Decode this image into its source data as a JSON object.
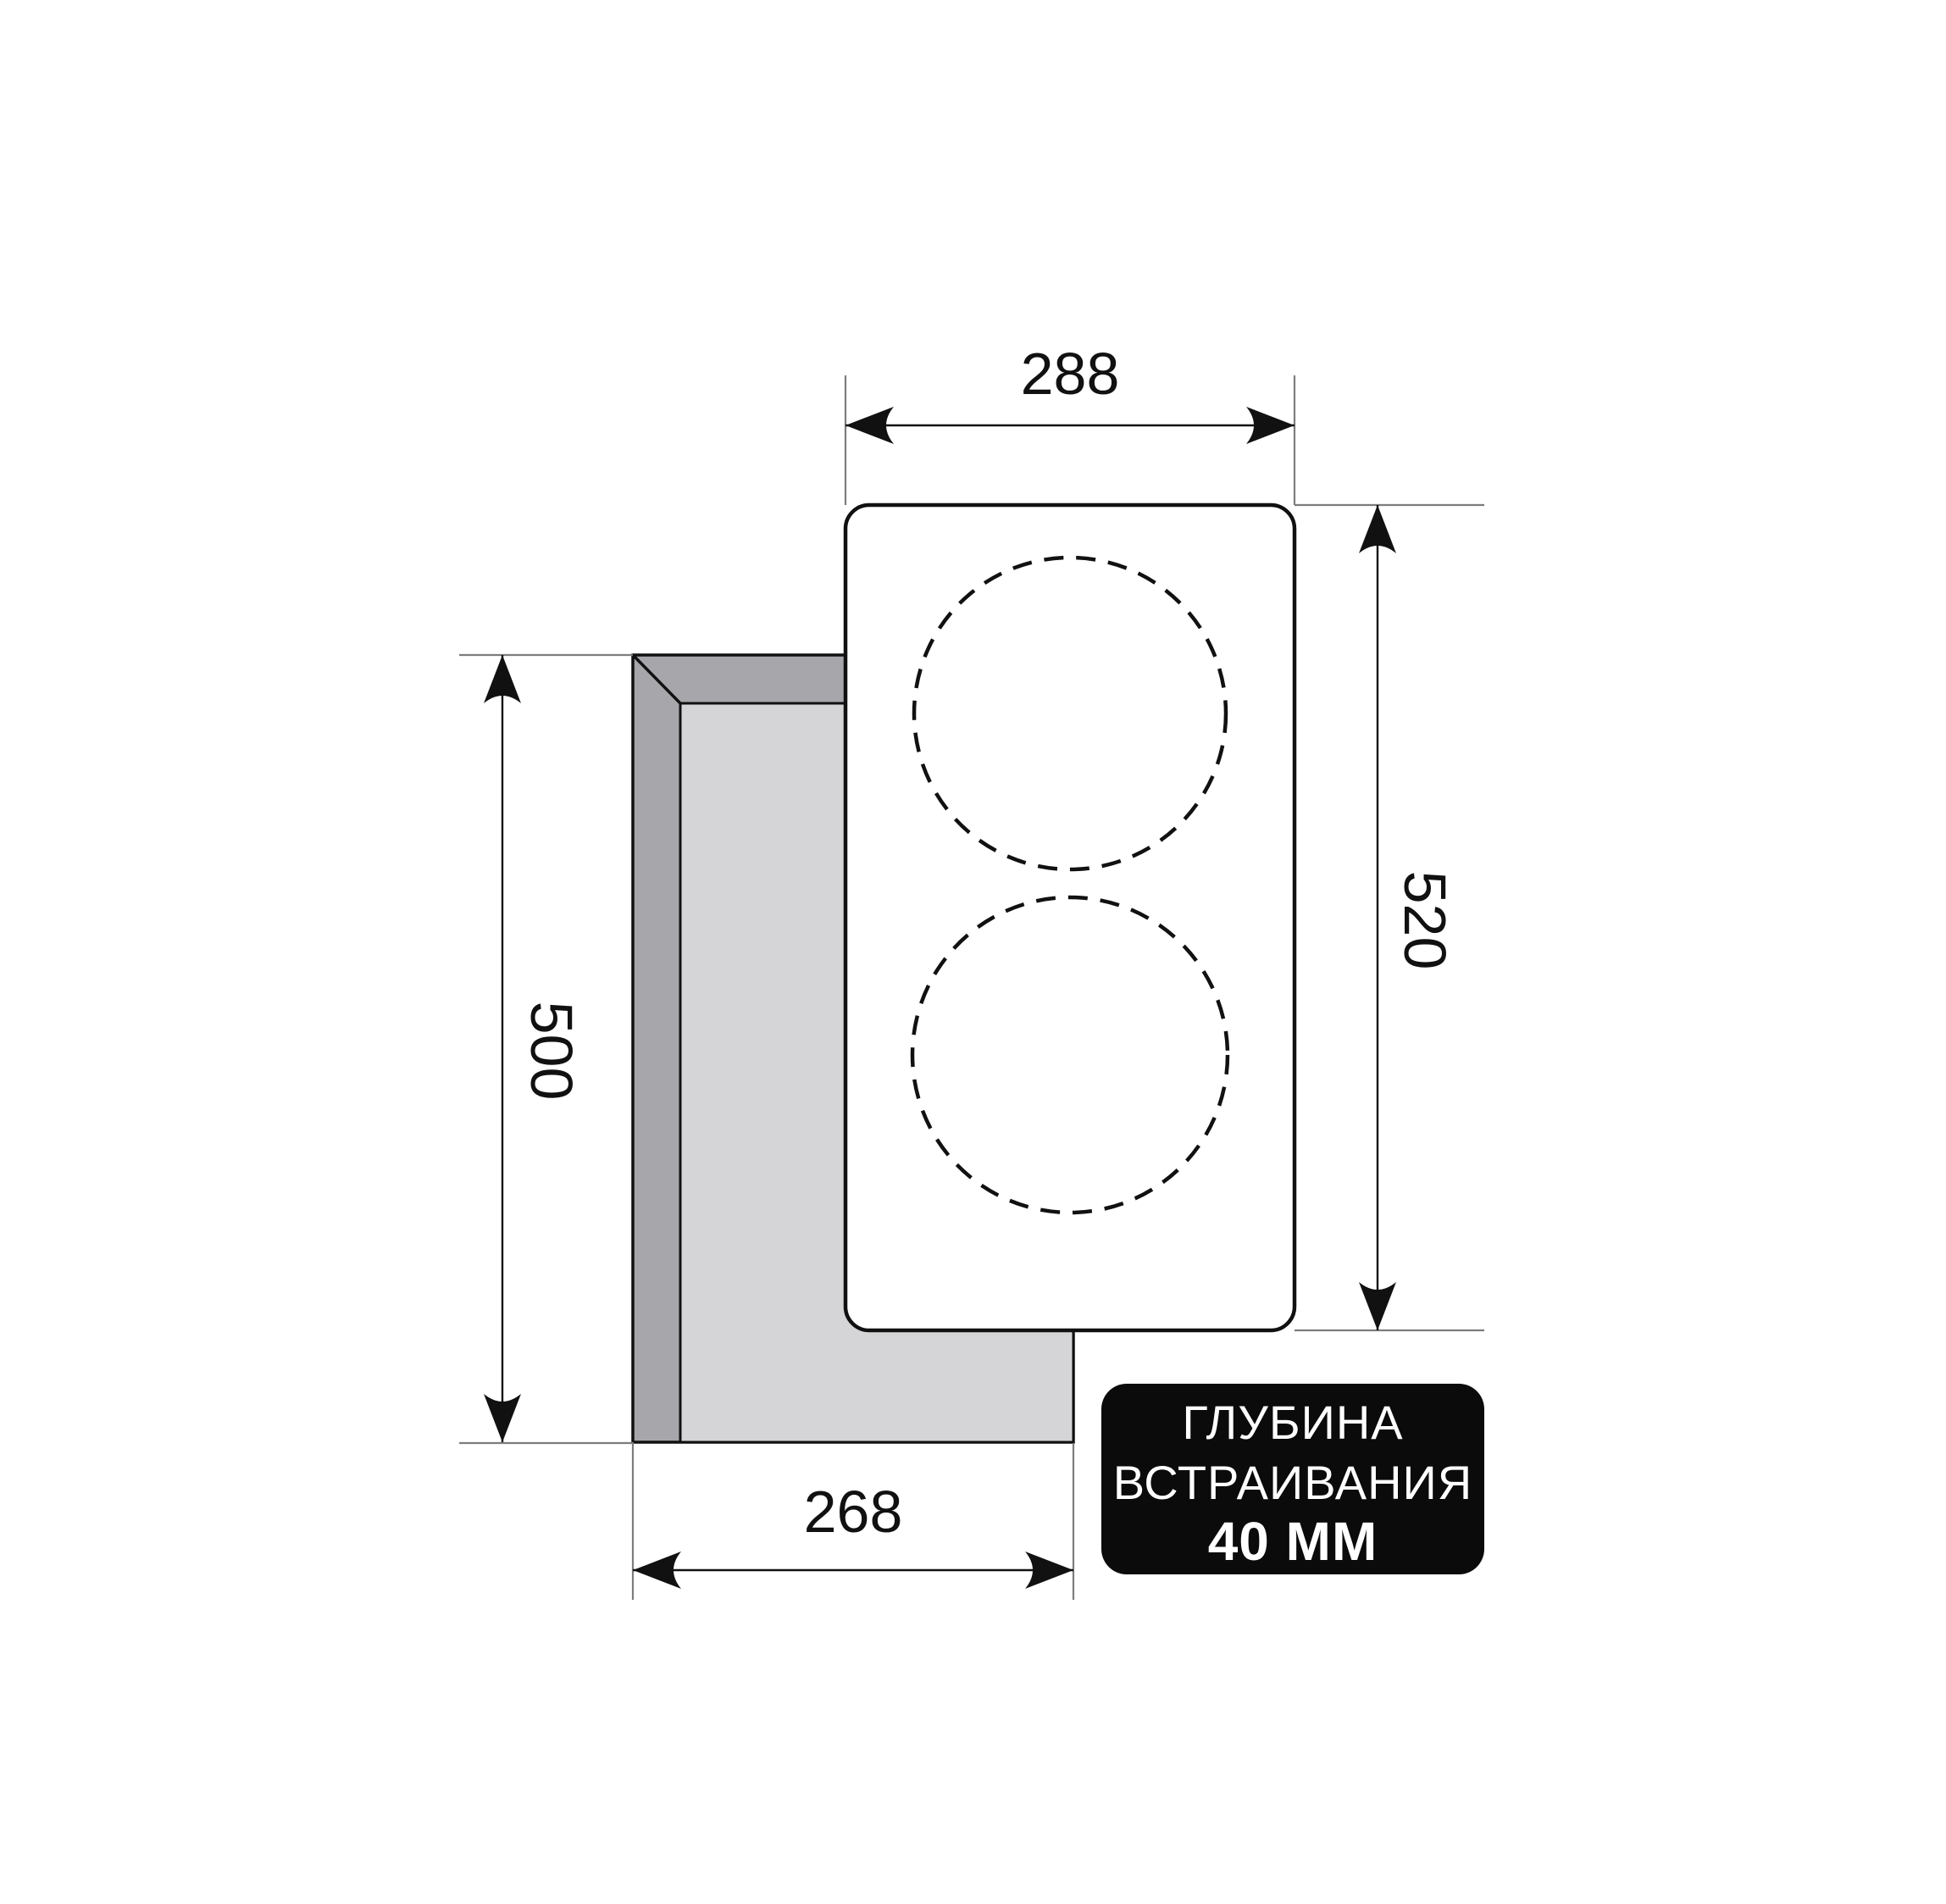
{
  "dimensions": {
    "top_width": "288",
    "right_height": "520",
    "left_height": "500",
    "bottom_width": "268"
  },
  "badge": {
    "title_line1": "ГЛУБИНА",
    "title_line2": "ВСТРАИВАНИЯ",
    "depth_value": "40 ММ"
  },
  "colors": {
    "cutout_side": "#a7a7ab",
    "cutout_inner": "#d5d5d7",
    "hob_fill": "#ffffff",
    "outline": "#111111",
    "extension_line": "#7d7d7d",
    "badge_background": "#0b0b0b",
    "badge_text": "#ffffff"
  }
}
